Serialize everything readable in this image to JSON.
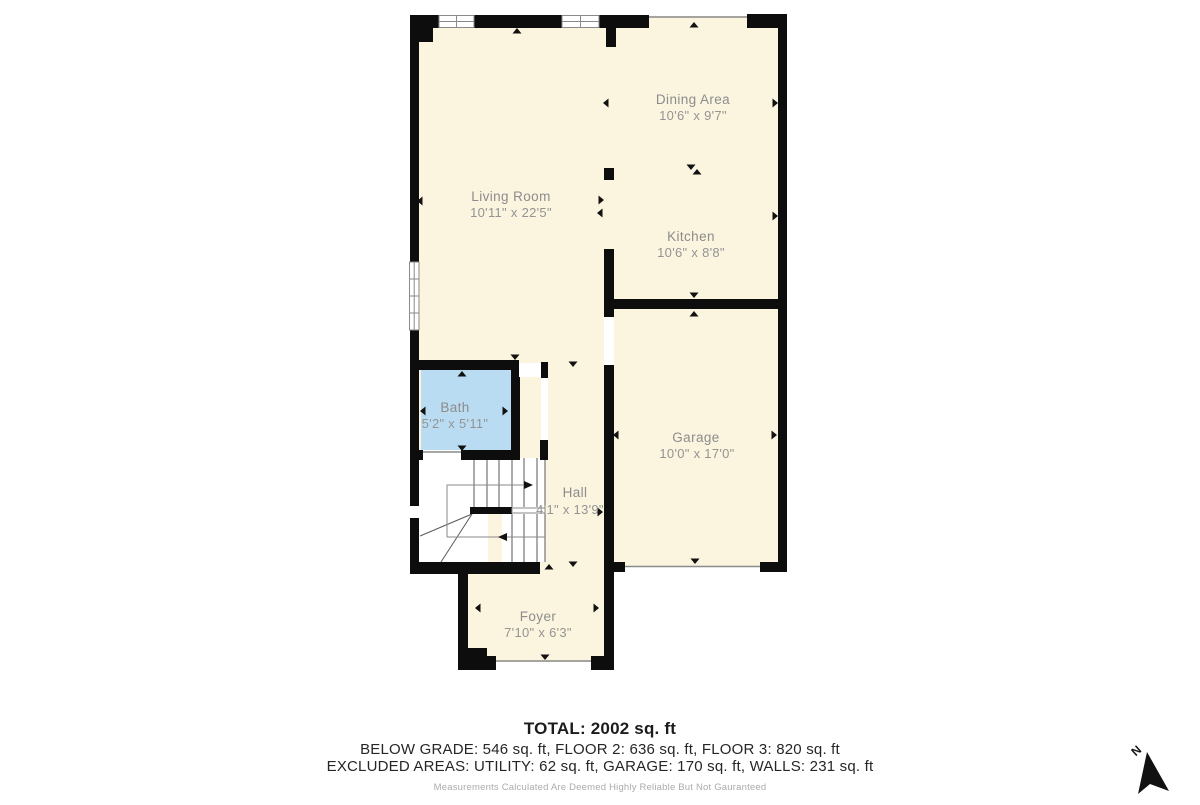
{
  "plan": {
    "rooms": [
      {
        "name": "Dining Area",
        "dims": "10'6\" x 9'7\""
      },
      {
        "name": "Living Room",
        "dims": "10'11\" x 22'5\""
      },
      {
        "name": "Kitchen",
        "dims": "10'6\" x 8'8\""
      },
      {
        "name": "Bath",
        "dims": "5'2\" x 5'11\""
      },
      {
        "name": "Garage",
        "dims": "10'0\" x 17'0\""
      },
      {
        "name": "Hall",
        "dims": "4'1\" x 13'9\""
      },
      {
        "name": "Foyer",
        "dims": "7'10\" x 6'3\""
      }
    ],
    "north_label": "N"
  },
  "summary": {
    "total": "TOTAL: 2002 sq. ft",
    "floors": "BELOW GRADE: 546 sq. ft, FLOOR 2: 636 sq. ft, FLOOR 3: 820 sq. ft",
    "excluded": "EXCLUDED AREAS: UTILITY: 62 sq. ft, GARAGE: 170 sq. ft, WALLS: 231 sq. ft",
    "disclaimer": "Measurements Calculated Are Deemed Highly Reliable But Not Gauranteed"
  },
  "colors": {
    "floor": "#FBF4DF",
    "bath_floor": "#BADCF2",
    "wall": "#0D0D0D",
    "label_text": "#8C8C8C",
    "opening_line": "#8A8A8A",
    "stair_line": "#5A5A5A"
  }
}
